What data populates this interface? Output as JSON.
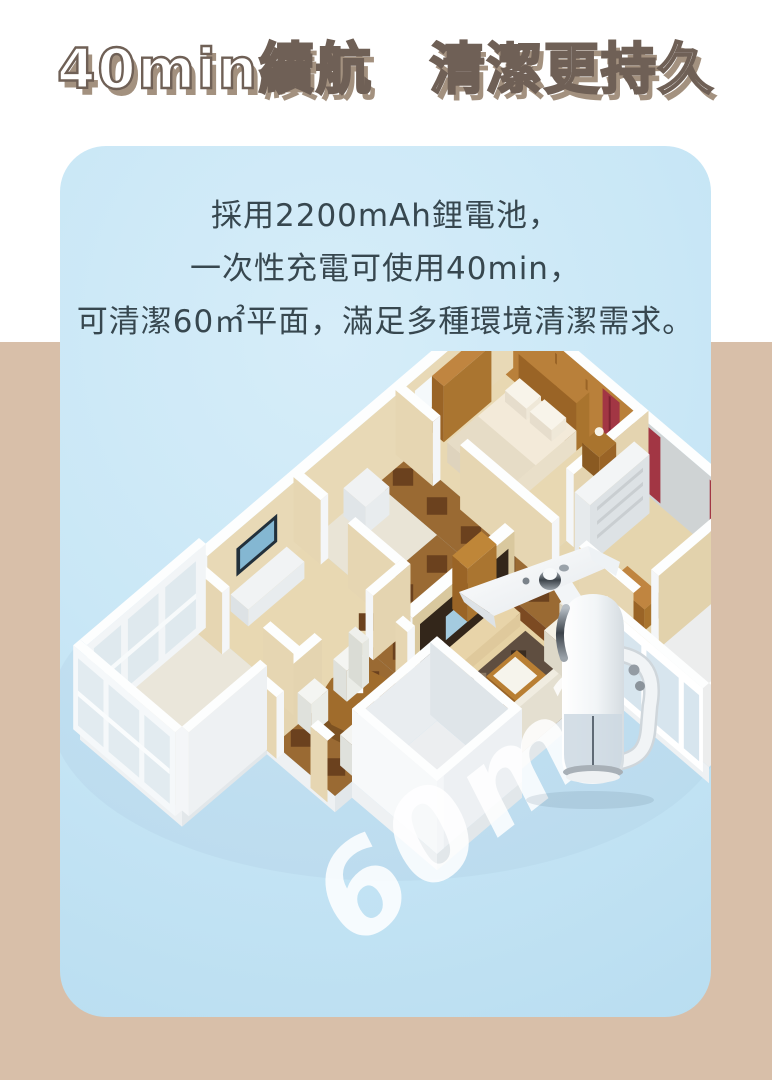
{
  "page": {
    "background_top_color": "#ffffff",
    "background_bottom_color": "#d8bfa9"
  },
  "title": {
    "text": "40min續航　清潔更持久",
    "fill_color": "#ffffff",
    "outline_color": "#6f6056",
    "shadow_color": "#a3917f"
  },
  "card": {
    "background_color": "#c3e4f4",
    "text_color": "#37474f",
    "description_lines": [
      "採用2200mAh鋰電池，",
      "一次性充電可使用40min，",
      "可清潔60㎡平面，滿足多種環境清潔需求。"
    ]
  },
  "illustrations": {
    "floor_plan": "isometric-apartment-floor-plan",
    "product": "handheld-electric-mop-cleaner"
  },
  "watermark": {
    "text": "60m",
    "superscript": "2",
    "color": "#ffffff"
  }
}
